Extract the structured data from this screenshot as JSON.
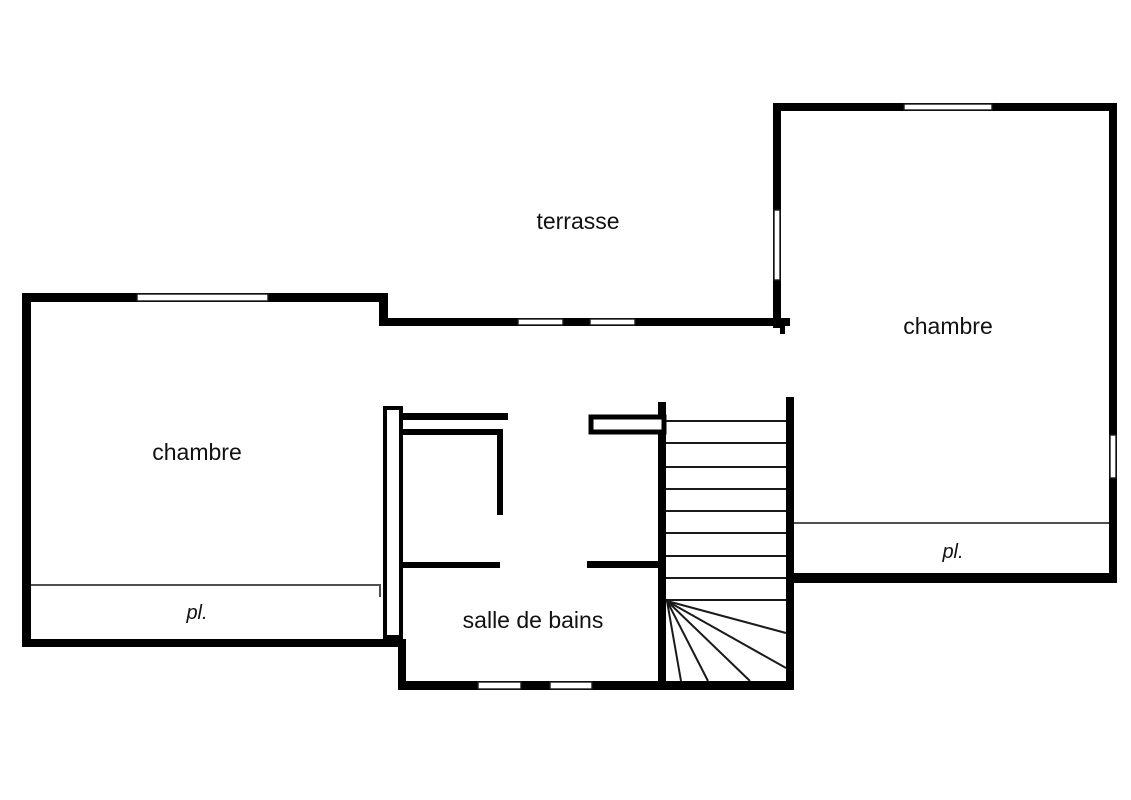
{
  "meta": {
    "type": "architectural-floor-plan",
    "language": "French"
  },
  "canvas": {
    "width": 1131,
    "height": 800,
    "background": "#ffffff"
  },
  "colors": {
    "wall": "#000000",
    "window_fill": "#ffffff",
    "window_stroke": "#1a1a1a",
    "thin_line": "#4f4f4f",
    "stair_line": "#1a1a1a",
    "label": "#111111"
  },
  "labels": [
    {
      "id": "terrasse",
      "text": "terrasse",
      "x": 578,
      "y": 229,
      "size": 23,
      "italic": false
    },
    {
      "id": "chambre-left",
      "text": "chambre",
      "x": 197,
      "y": 460,
      "size": 23,
      "italic": false
    },
    {
      "id": "chambre-right",
      "text": "chambre",
      "x": 948,
      "y": 334,
      "size": 23,
      "italic": false
    },
    {
      "id": "salle-de-bains",
      "text": "salle de bains",
      "x": 533,
      "y": 628,
      "size": 23,
      "italic": false
    },
    {
      "id": "placard-left",
      "text": "pl.",
      "x": 197,
      "y": 619,
      "size": 20,
      "italic": true
    },
    {
      "id": "placard-right",
      "text": "pl.",
      "x": 953,
      "y": 558,
      "size": 20,
      "italic": true
    }
  ],
  "walls": [
    {
      "name": "left-room-top-wall",
      "x": 22,
      "y": 293,
      "w": 366,
      "h": 9
    },
    {
      "name": "left-room-left-wall",
      "x": 22,
      "y": 293,
      "w": 9,
      "h": 354
    },
    {
      "name": "left-room-bottom-wall",
      "x": 22,
      "y": 639,
      "w": 384,
      "h": 8
    },
    {
      "name": "left-room-right-wall-stub",
      "x": 379,
      "y": 301,
      "w": 9,
      "h": 25
    },
    {
      "name": "terrace-wall",
      "x": 379,
      "y": 318,
      "w": 411,
      "h": 8
    },
    {
      "name": "terrace-wall-end-tab",
      "x": 780,
      "y": 326,
      "w": 5,
      "h": 8
    },
    {
      "name": "right-room-top-wall",
      "x": 773,
      "y": 103,
      "w": 344,
      "h": 8
    },
    {
      "name": "right-room-left-wall",
      "x": 773,
      "y": 103,
      "w": 8,
      "h": 225
    },
    {
      "name": "right-room-right-wall",
      "x": 1109,
      "y": 103,
      "w": 8,
      "h": 480
    },
    {
      "name": "right-room-bottom-wall",
      "x": 786,
      "y": 573,
      "w": 331,
      "h": 10
    },
    {
      "name": "stairwell-left-wall",
      "x": 658,
      "y": 402,
      "w": 8,
      "h": 288
    },
    {
      "name": "stairwell-right-wall",
      "x": 786,
      "y": 397,
      "w": 8,
      "h": 293
    },
    {
      "name": "bathroom-bottom-wall",
      "x": 398,
      "y": 681,
      "w": 396,
      "h": 9
    },
    {
      "name": "bathroom-left-wall-lower",
      "x": 398,
      "y": 639,
      "w": 8,
      "h": 51
    },
    {
      "name": "bathroom-top-wall",
      "x": 402,
      "y": 413,
      "w": 106,
      "h": 7
    },
    {
      "name": "shower-wall-horizontal",
      "x": 403,
      "y": 429,
      "w": 100,
      "h": 6
    },
    {
      "name": "shower-wall-vertical",
      "x": 497,
      "y": 429,
      "w": 6,
      "h": 86
    },
    {
      "name": "bathroom-mid-wall-left",
      "x": 402,
      "y": 562,
      "w": 98,
      "h": 6
    },
    {
      "name": "bathroom-mid-wall-right",
      "x": 587,
      "y": 561,
      "w": 71,
      "h": 7
    }
  ],
  "outlined_walls": [
    {
      "name": "bathroom-left-partition",
      "x": 385,
      "y": 408,
      "w": 16,
      "h": 229,
      "stroke": 4
    },
    {
      "name": "stair-landing-partition",
      "x": 591,
      "y": 417,
      "w": 73,
      "h": 15,
      "stroke": 5
    }
  ],
  "windows": [
    {
      "name": "left-room-top-window",
      "x": 137,
      "y": 294,
      "w": 131,
      "h": 7
    },
    {
      "name": "terrace-window-1",
      "x": 518,
      "y": 319,
      "w": 45,
      "h": 6
    },
    {
      "name": "terrace-window-2",
      "x": 590,
      "y": 319,
      "w": 45,
      "h": 6
    },
    {
      "name": "right-room-top-window",
      "x": 904,
      "y": 104,
      "w": 88,
      "h": 6
    },
    {
      "name": "right-room-left-window",
      "x": 774,
      "y": 210,
      "w": 6,
      "h": 70
    },
    {
      "name": "right-room-right-window",
      "x": 1110,
      "y": 435,
      "w": 6,
      "h": 43
    },
    {
      "name": "bathroom-bottom-window-1",
      "x": 478,
      "y": 682,
      "w": 43,
      "h": 7
    },
    {
      "name": "bathroom-bottom-window-2",
      "x": 550,
      "y": 682,
      "w": 42,
      "h": 7
    }
  ],
  "thin_lines": [
    {
      "name": "closet-divider-left",
      "x1": 31,
      "y1": 585,
      "x2": 381,
      "y2": 585
    },
    {
      "name": "closet-divider-left-tick",
      "x1": 380,
      "y1": 585,
      "x2": 380,
      "y2": 597
    },
    {
      "name": "closet-divider-right",
      "x1": 794,
      "y1": 523,
      "x2": 1109,
      "y2": 523
    }
  ],
  "stairs": {
    "tread_x1": 666,
    "tread_x2": 786,
    "tread_ys": [
      421,
      443,
      467,
      489,
      511,
      533,
      556,
      578,
      600
    ],
    "hub": {
      "x": 667,
      "y": 601
    },
    "winder_ends": [
      {
        "x": 786,
        "y": 633
      },
      {
        "x": 786,
        "y": 668
      },
      {
        "x": 750,
        "y": 681
      },
      {
        "x": 708,
        "y": 681
      },
      {
        "x": 681,
        "y": 681
      }
    ]
  }
}
